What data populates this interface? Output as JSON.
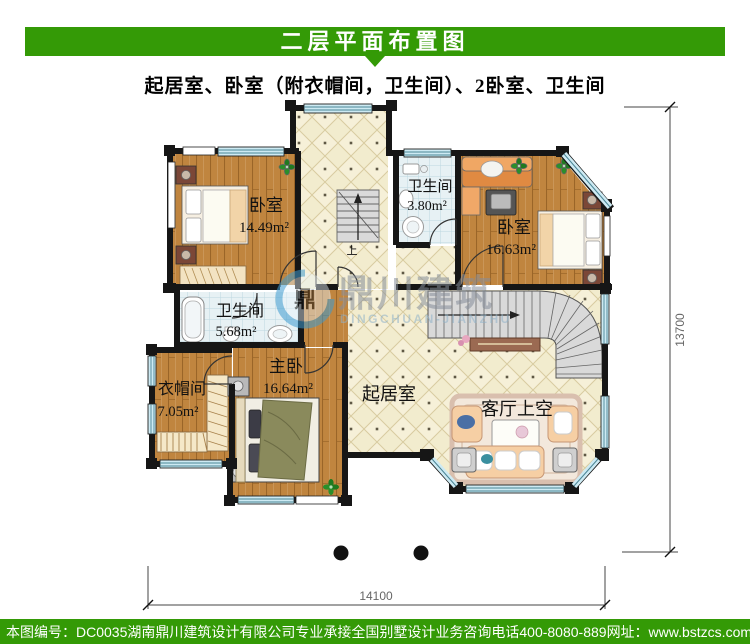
{
  "header": {
    "title": "二层平面布置图",
    "subtitle": "起居室、卧室（附衣帽间，卫生间）、2卧室、卫生间"
  },
  "rooms": {
    "bedroom_tl": {
      "name": "卧室",
      "area": "14.49m²"
    },
    "bath_top": {
      "name": "卫生间",
      "area": "3.80m²"
    },
    "bedroom_tr": {
      "name": "卧室",
      "area": "16.63m²"
    },
    "bath_mid": {
      "name": "卫生间",
      "area": "5.68m²"
    },
    "cloakroom": {
      "name": "衣帽间",
      "area": "7.05m²"
    },
    "master": {
      "name": "主卧",
      "area": "16.64m²"
    },
    "living": {
      "name": "起居室"
    },
    "void": {
      "name": "客厅上空"
    }
  },
  "stairs": {
    "up_label": "上"
  },
  "dimensions": {
    "right": "13700",
    "bottom": "14100"
  },
  "watermark": {
    "logo_char": "鼎",
    "cn": "鼎川建筑",
    "en": "DINGCHUAN-JIANZHU"
  },
  "footer": {
    "serial": "本图编号：DC0035",
    "company": "湖南鼎川建筑设计有限公司专业承接全国别墅设计业务",
    "phone": "咨询电话400-8080-889",
    "site": "网址：www.bstzcs.com"
  },
  "colors": {
    "accent_green": "#349a06",
    "wood": "#c0853f",
    "tile": "#f2ecce",
    "window": "#cdeaf3"
  }
}
